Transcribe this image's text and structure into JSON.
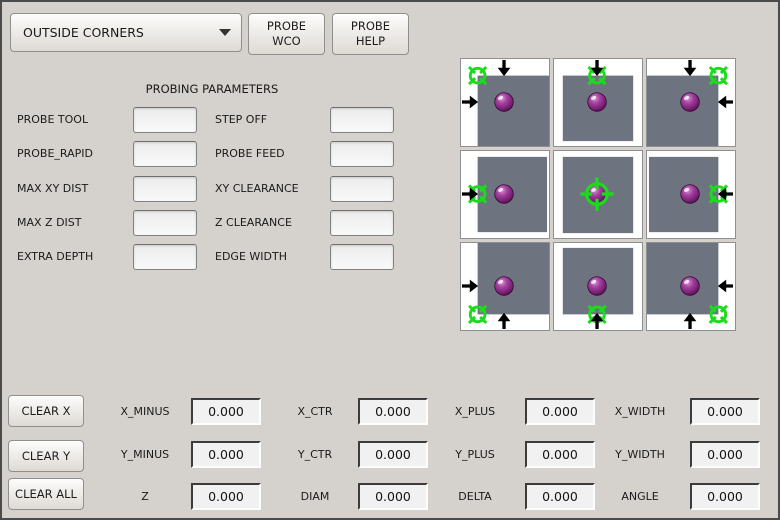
{
  "header": {
    "mode_dropdown": {
      "value": "OUTSIDE CORNERS"
    },
    "probe_wco_label": "PROBE\nWCO",
    "probe_help_label": "PROBE\nHELP"
  },
  "icons": {
    "dropdown_arrow": "chevron-down",
    "probe_target": "green-crosshair",
    "probe_tip": "purple-sphere",
    "approach": "black-arrow"
  },
  "params": {
    "title": "PROBING PARAMETERS",
    "rows": [
      {
        "left": {
          "label": "PROBE TOOL",
          "value": ""
        },
        "right": {
          "label": "STEP OFF",
          "value": ""
        }
      },
      {
        "left": {
          "label": "PROBE_RAPID",
          "value": ""
        },
        "right": {
          "label": "PROBE FEED",
          "value": ""
        }
      },
      {
        "left": {
          "label": "MAX XY DIST",
          "value": ""
        },
        "right": {
          "label": "XY CLEARANCE",
          "value": ""
        }
      },
      {
        "left": {
          "label": "MAX Z DIST",
          "value": ""
        },
        "right": {
          "label": "Z CLEARANCE",
          "value": ""
        }
      },
      {
        "left": {
          "label": "EXTRA DEPTH",
          "value": ""
        },
        "right": {
          "label": "EDGE WIDTH",
          "value": ""
        }
      }
    ]
  },
  "probe_grid": {
    "cells": [
      {
        "name": "outside-corner-top-left"
      },
      {
        "name": "edge-top"
      },
      {
        "name": "outside-corner-top-right"
      },
      {
        "name": "edge-left"
      },
      {
        "name": "center"
      },
      {
        "name": "edge-right"
      },
      {
        "name": "outside-corner-bottom-left"
      },
      {
        "name": "edge-bottom"
      },
      {
        "name": "outside-corner-bottom-right"
      }
    ],
    "colors": {
      "workpiece": "#6d7480",
      "crosshair": "#1bdc1b",
      "arrow": "#000000",
      "sphere": "#8b2a8b",
      "cell_background": "#ffffff"
    }
  },
  "results": {
    "clear_buttons": [
      {
        "label": "CLEAR X"
      },
      {
        "label": "CLEAR Y"
      },
      {
        "label": "CLEAR ALL"
      }
    ],
    "rows": [
      {
        "cells": [
          {
            "label": "X_MINUS",
            "value": "0.000"
          },
          {
            "label": "X_CTR",
            "value": "0.000"
          },
          {
            "label": "X_PLUS",
            "value": "0.000"
          },
          {
            "label": "X_WIDTH",
            "value": "0.000"
          }
        ]
      },
      {
        "cells": [
          {
            "label": "Y_MINUS",
            "value": "0.000"
          },
          {
            "label": "Y_CTR",
            "value": "0.000"
          },
          {
            "label": "Y_PLUS",
            "value": "0.000"
          },
          {
            "label": "Y_WIDTH",
            "value": "0.000"
          }
        ]
      },
      {
        "cells": [
          {
            "label": "Z",
            "value": "0.000"
          },
          {
            "label": "DIAM",
            "value": "0.000"
          },
          {
            "label": "DELTA",
            "value": "0.000"
          },
          {
            "label": "ANGLE",
            "value": "0.000"
          }
        ]
      }
    ]
  },
  "window": {
    "background": "#d5d2cd",
    "border": "#4b4b4b"
  }
}
